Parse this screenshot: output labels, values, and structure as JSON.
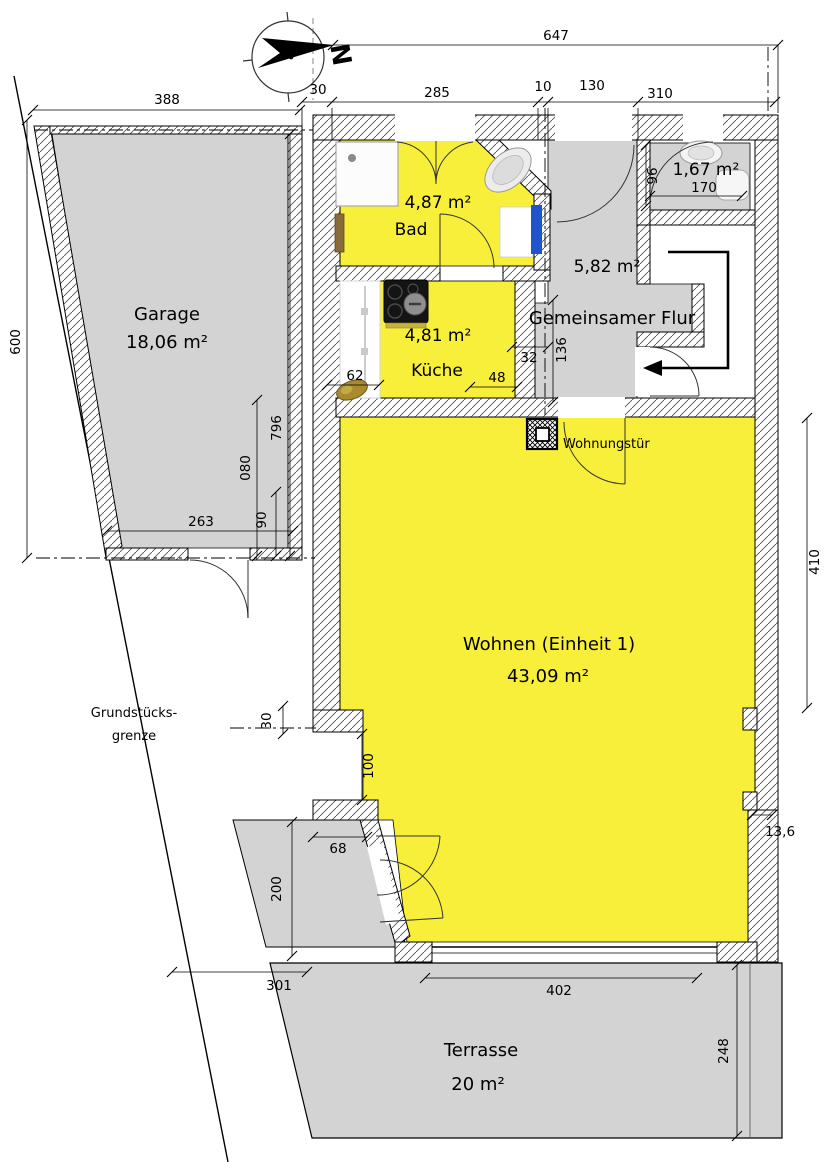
{
  "meta": {
    "drawing_type": "floor-plan"
  },
  "compass": {
    "label": "N"
  },
  "rooms": {
    "garage": {
      "name": "Garage",
      "area": "18,06 m²"
    },
    "bad": {
      "name": "Bad",
      "area": "4,87 m²"
    },
    "kueche": {
      "name": "Küche",
      "area": "4,81 m²"
    },
    "flur": {
      "name": "Gemeinsamer Flur",
      "area": "5,82 m²"
    },
    "wc": {
      "area": "1,67 m²"
    },
    "wohnen": {
      "name": "Wohnen (Einheit 1)",
      "area": "43,09 m²"
    },
    "terrasse": {
      "name": "Terrasse",
      "area": "20 m²"
    }
  },
  "labels": {
    "apartment_door": "Wohnungstür",
    "property_boundary_line1": "Grundstücks-",
    "property_boundary_line2": "grenze"
  },
  "dimensions": {
    "top_total": "647",
    "garage_width": "388",
    "gap_garage_building": "30",
    "bad_width": "285",
    "small_gap": "10",
    "flur_width": "130",
    "right_width": "310",
    "garage_left_height": "600",
    "garage_right_height": "796",
    "d080": "080",
    "d90": "90",
    "garage_inner_width": "263",
    "wc_height": "96",
    "wc_width": "170",
    "flur_notch": "32",
    "flur_height": "136",
    "kueche_left": "62",
    "kueche_right": "48",
    "wohnen_right_height": "410",
    "wall_step": "30",
    "niche_height": "100",
    "niche_width": "68",
    "path_height": "200",
    "wall_thickness": "13,6",
    "terrace_left": "301",
    "terrace_door_width": "402",
    "terrace_height": "248"
  },
  "colors": {
    "highlight_yellow": "#F7EF39",
    "room_gray": "#D3D3D3",
    "accent_blue": "#1F54CC"
  }
}
